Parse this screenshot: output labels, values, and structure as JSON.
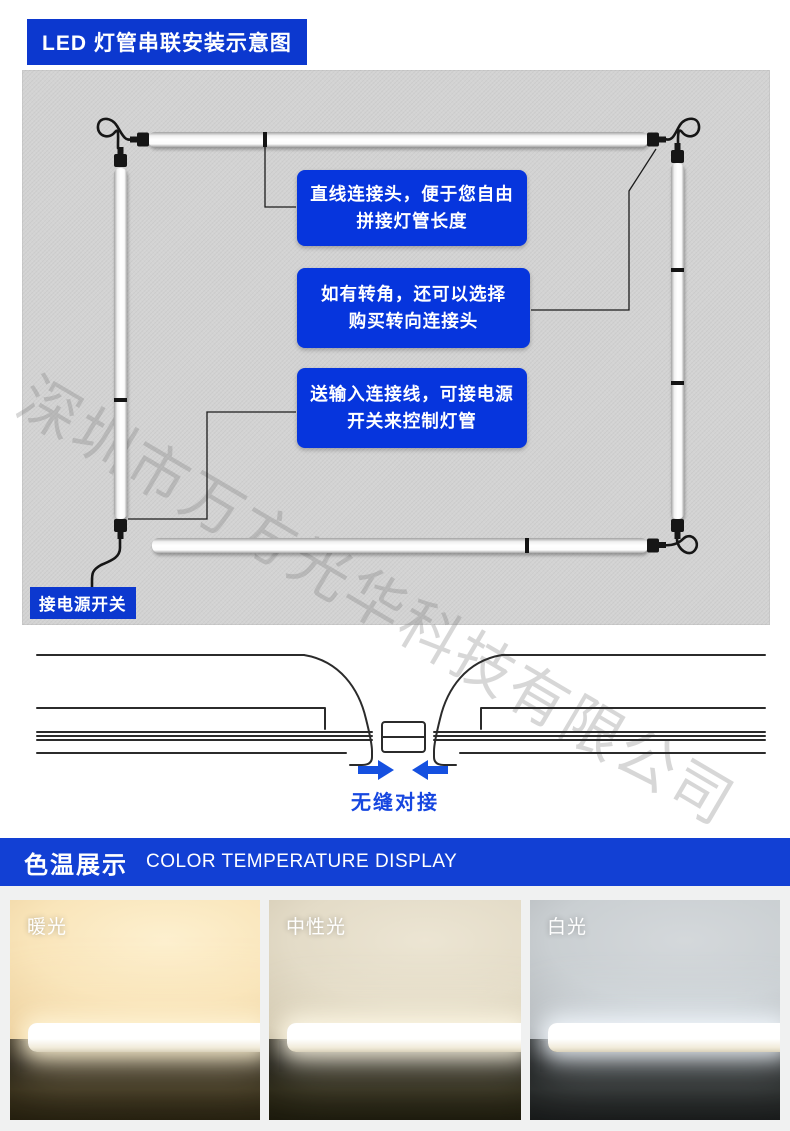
{
  "header": {
    "title": "LED 灯管串联安装示意图",
    "bg_color": "#0c38cf"
  },
  "diagram": {
    "panel_bg": "#d3d3d3",
    "callout_bg": "#0635dd",
    "callouts": [
      {
        "line1": "直线连接头，便于您自由",
        "line2": "拼接灯管长度"
      },
      {
        "line1": "如有转角，还可以选择",
        "line2": "购买转向连接头"
      },
      {
        "line1": "送输入连接线，可接电源",
        "line2": "开关来控制灯管"
      }
    ],
    "power_label": "接电源开关",
    "watermark": "深圳市万方光华科技有限公司"
  },
  "joint_section": {
    "caption": "无缝对接",
    "arrow_color": "#1550e0"
  },
  "banner": {
    "title_cn": "色温展示",
    "title_en": "COLOR TEMPERATURE DISPLAY",
    "bg_color": "#1240d4"
  },
  "color_panels": [
    {
      "label": "暖光"
    },
    {
      "label": "中性光"
    },
    {
      "label": "白光"
    }
  ]
}
